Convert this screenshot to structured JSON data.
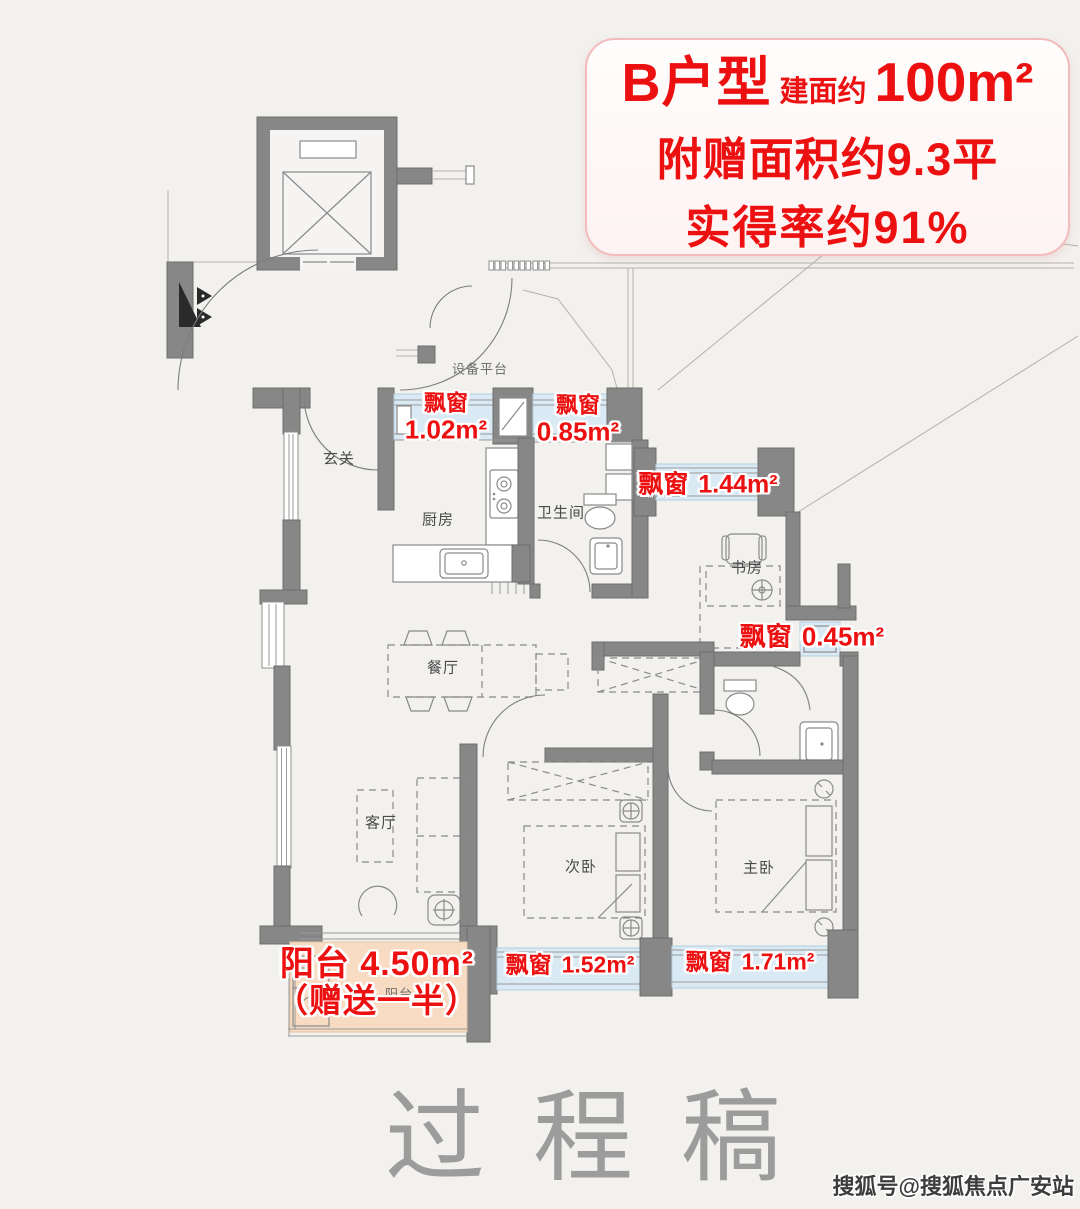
{
  "title_card": {
    "model": "B户型",
    "area_prefix": "建面约",
    "area_value": "100m²",
    "line2": "附赠面积约9.3平",
    "line3": "实得率约91%"
  },
  "room_labels": {
    "entry": "玄关",
    "equipment_platform": "设备平台",
    "kitchen": "厨房",
    "bathroom": "卫生间",
    "study": "书房",
    "dining": "餐厅",
    "living": "客厅",
    "second_bedroom": "次卧",
    "master_bedroom": "主卧",
    "balcony": "阳台"
  },
  "bay_labels": {
    "bay1": {
      "label": "飘窗",
      "area": "1.02m²"
    },
    "bay2": {
      "label": "飘窗",
      "area": "0.85m²"
    },
    "bay3": {
      "label": "飘窗",
      "area": "1.44m²"
    },
    "bay4": {
      "label": "飘窗",
      "area": "0.45m²"
    },
    "bay5": {
      "label": "飘窗",
      "area": "1.52m²"
    },
    "bay6": {
      "label": "飘窗",
      "area": "1.71m²"
    }
  },
  "balcony_label": {
    "line1": "阳台 4.50m²",
    "line2": "（赠送一半）"
  },
  "watermark": "过程稿",
  "credit": "搜狐号@搜狐焦点广安站",
  "colors": {
    "accent": "#ec1010",
    "wall": "#878787",
    "bay_fill": "#daeaf5",
    "balcony_fill": "#f7dcc3",
    "background": "#f2f1ee",
    "watermark": "#9c9c9c",
    "line": "#8a8a8a"
  }
}
